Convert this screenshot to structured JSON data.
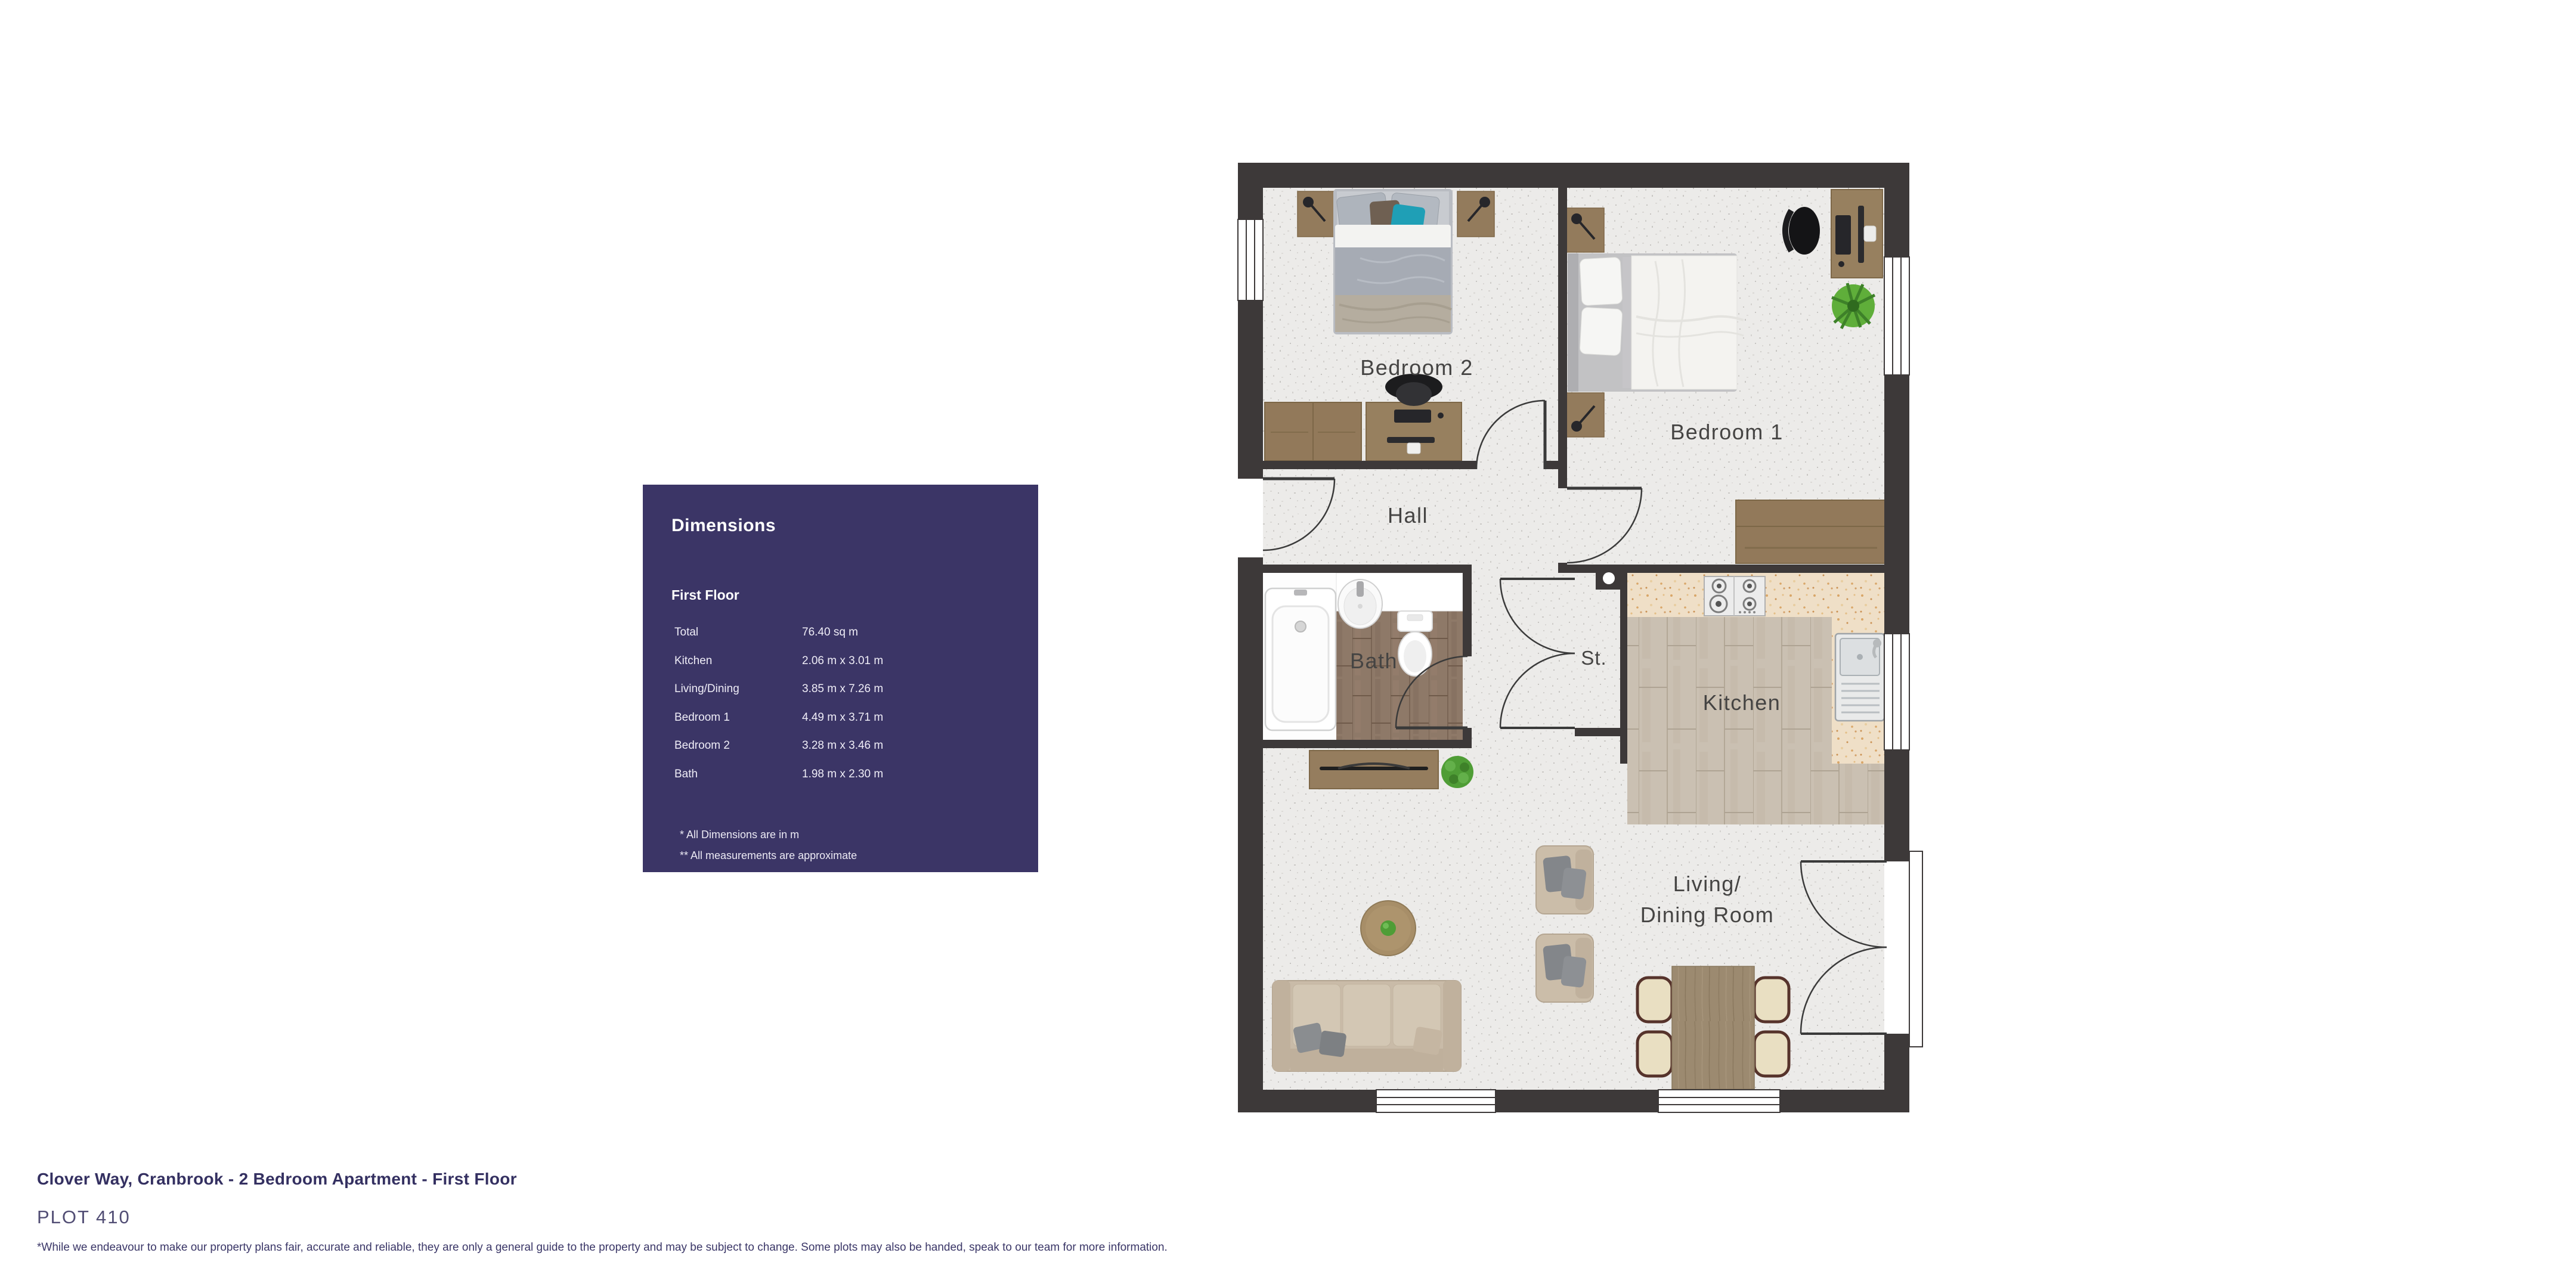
{
  "footer": {
    "title": "Clover Way, Cranbrook - 2 Bedroom Apartment - First Floor",
    "plot": "PLOT 410",
    "disclaimer": "*While we endeavour to make our property plans fair, accurate and reliable, they are only a general guide to the property and may be subject to change. Some plots may also be handed, speak to our team for more information."
  },
  "dimensions_panel": {
    "title": "Dimensions",
    "floor": "First Floor",
    "rows": [
      {
        "label": "Total",
        "value": "76.40 sq m"
      },
      {
        "label": "Kitchen",
        "value": "2.06 m x 3.01 m"
      },
      {
        "label": "Living/Dining",
        "value": "3.85 m x 7.26 m"
      },
      {
        "label": "Bedroom 1",
        "value": "4.49 m x 3.71 m"
      },
      {
        "label": "Bedroom 2",
        "value": "3.28 m x 3.46 m"
      },
      {
        "label": "Bath",
        "value": "1.98 m x 2.30 m"
      }
    ],
    "footnotes": [
      "* All Dimensions are in m",
      "** All measurements are approximate"
    ],
    "panel_color": "#3b3566"
  },
  "floorplan": {
    "rooms": {
      "bedroom2": "Bedroom 2",
      "bedroom1": "Bedroom 1",
      "hall": "Hall",
      "bath": "Bath",
      "storage": "St.",
      "kitchen": "Kitchen",
      "living_line1": "Living/",
      "living_line2": "Dining Room"
    },
    "wall_color": "#3d3939",
    "accent_teal_pillow": "#1f9fb6"
  }
}
